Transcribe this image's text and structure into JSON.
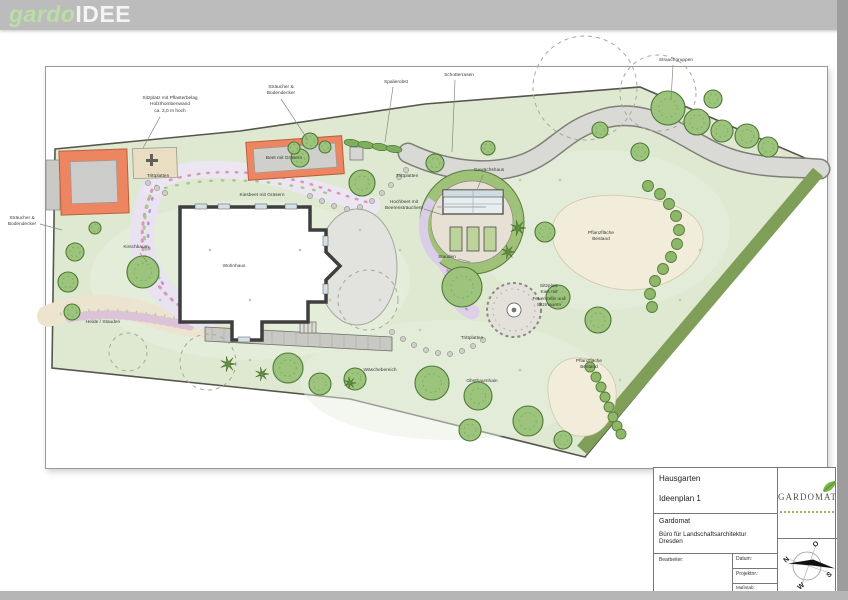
{
  "header": {
    "logo_part1": "gardo",
    "logo_part2": "IDEE"
  },
  "plan": {
    "labels": [
      {
        "id": "sitzplatz-pflaster",
        "text": "Sitzplatz mit Pflasterbelag\nHolzrhombenwand\nca. 2,0 m hoch",
        "x": 170,
        "y": 96,
        "leader": [
          160,
          117,
          143,
          148
        ]
      },
      {
        "id": "straeucher-top",
        "text": "Sträucher &\nBodendecker",
        "x": 281,
        "y": 85,
        "leader": [
          281,
          99,
          308,
          140
        ]
      },
      {
        "id": "spalierobst",
        "text": "Spalierobst",
        "x": 396,
        "y": 80,
        "leader": [
          393,
          87,
          385,
          142
        ]
      },
      {
        "id": "schotterrasen",
        "text": "Schotterrasen",
        "x": 459,
        "y": 73,
        "leader": [
          455,
          80,
          452,
          152
        ]
      },
      {
        "id": "strauchgruppen",
        "text": "Strauchgruppen",
        "x": 676,
        "y": 58,
        "leader": [
          673,
          65,
          671,
          100
        ]
      },
      {
        "id": "straeucher-left",
        "text": "Sträucher &\nBodendecker",
        "x": 22,
        "y": 216,
        "leader": [
          40,
          224,
          62,
          230
        ]
      },
      {
        "id": "trittplatten-1",
        "text": "Trittplatten",
        "x": 158,
        "y": 174
      },
      {
        "id": "beet-graeser",
        "text": "Beet mit Gräsern",
        "x": 284,
        "y": 156
      },
      {
        "id": "kiesbeet",
        "text": "Kiesbeet mit Gräsern",
        "x": 262,
        "y": 193
      },
      {
        "id": "trittplatten-2",
        "text": "Trittplatten",
        "x": 407,
        "y": 174
      },
      {
        "id": "gewaechshaus",
        "text": "Gewächshaus",
        "x": 489,
        "y": 168,
        "leader": [
          483,
          175,
          477,
          190
        ]
      },
      {
        "id": "hochbeet",
        "text": "Hochbeet mit\nBeerensträuchern",
        "x": 404,
        "y": 200,
        "leader": [
          424,
          209,
          443,
          215
        ]
      },
      {
        "id": "stauden",
        "text": "Stauden",
        "x": 447,
        "y": 255,
        "leader": [
          458,
          259,
          470,
          262
        ]
      },
      {
        "id": "sitzplatz-kies",
        "text": "Sitzplatz\nKies mit\nFeuerstelle und\nSitzmauern",
        "x": 549,
        "y": 284
      },
      {
        "id": "pflanzflaeche-1",
        "text": "Pflanzfläche\nBestand",
        "x": 601,
        "y": 231
      },
      {
        "id": "pflanzflaeche-2",
        "text": "Pflanzfläche\nBestand",
        "x": 589,
        "y": 359
      },
      {
        "id": "trittplatten-3",
        "text": "Trittplatten",
        "x": 472,
        "y": 336
      },
      {
        "id": "waeschebereich",
        "text": "Wäschebereich",
        "x": 380,
        "y": 368
      },
      {
        "id": "obstbaumhain",
        "text": "Obstbaumhain",
        "x": 482,
        "y": 379
      },
      {
        "id": "heide-stauden",
        "text": "Heide / Stauden",
        "x": 103,
        "y": 320
      },
      {
        "id": "kirschbaum",
        "text": "Kirschbaum",
        "x": 136,
        "y": 245,
        "leader": [
          140,
          253,
          147,
          262
        ]
      },
      {
        "id": "wohnhaus",
        "text": "Wohnhaus",
        "x": 234,
        "y": 264
      }
    ]
  },
  "title_block": {
    "project": "Hausgarten",
    "plan_name": "Ideenplan 1",
    "company": "Gardomat",
    "company_desc": "Büro für Landschaftsarchitektur\nDresden",
    "bearbeiter_label": "Bearbeiter:",
    "datum_label": "Datum:",
    "projektnr_label": "Projektnr.:",
    "massstab_label": "Maßstab:",
    "massstab_value": "1 : 100 DIN A3",
    "logo_text": "GARDOMAT"
  },
  "compass": {
    "n": "N",
    "o": "O",
    "s": "S",
    "w": "W"
  },
  "colors": {
    "header_gray": "#bcbcbc",
    "logo_green": "#b9dfa4",
    "lawn": "#dfe9d2",
    "gravel": "#d9d9d5",
    "accent_orange": "#ee8561",
    "tree_green": "#9cc47c",
    "hedge_green": "#8fb768",
    "strip_green": "#7f9f58",
    "cream": "#f1edda"
  }
}
